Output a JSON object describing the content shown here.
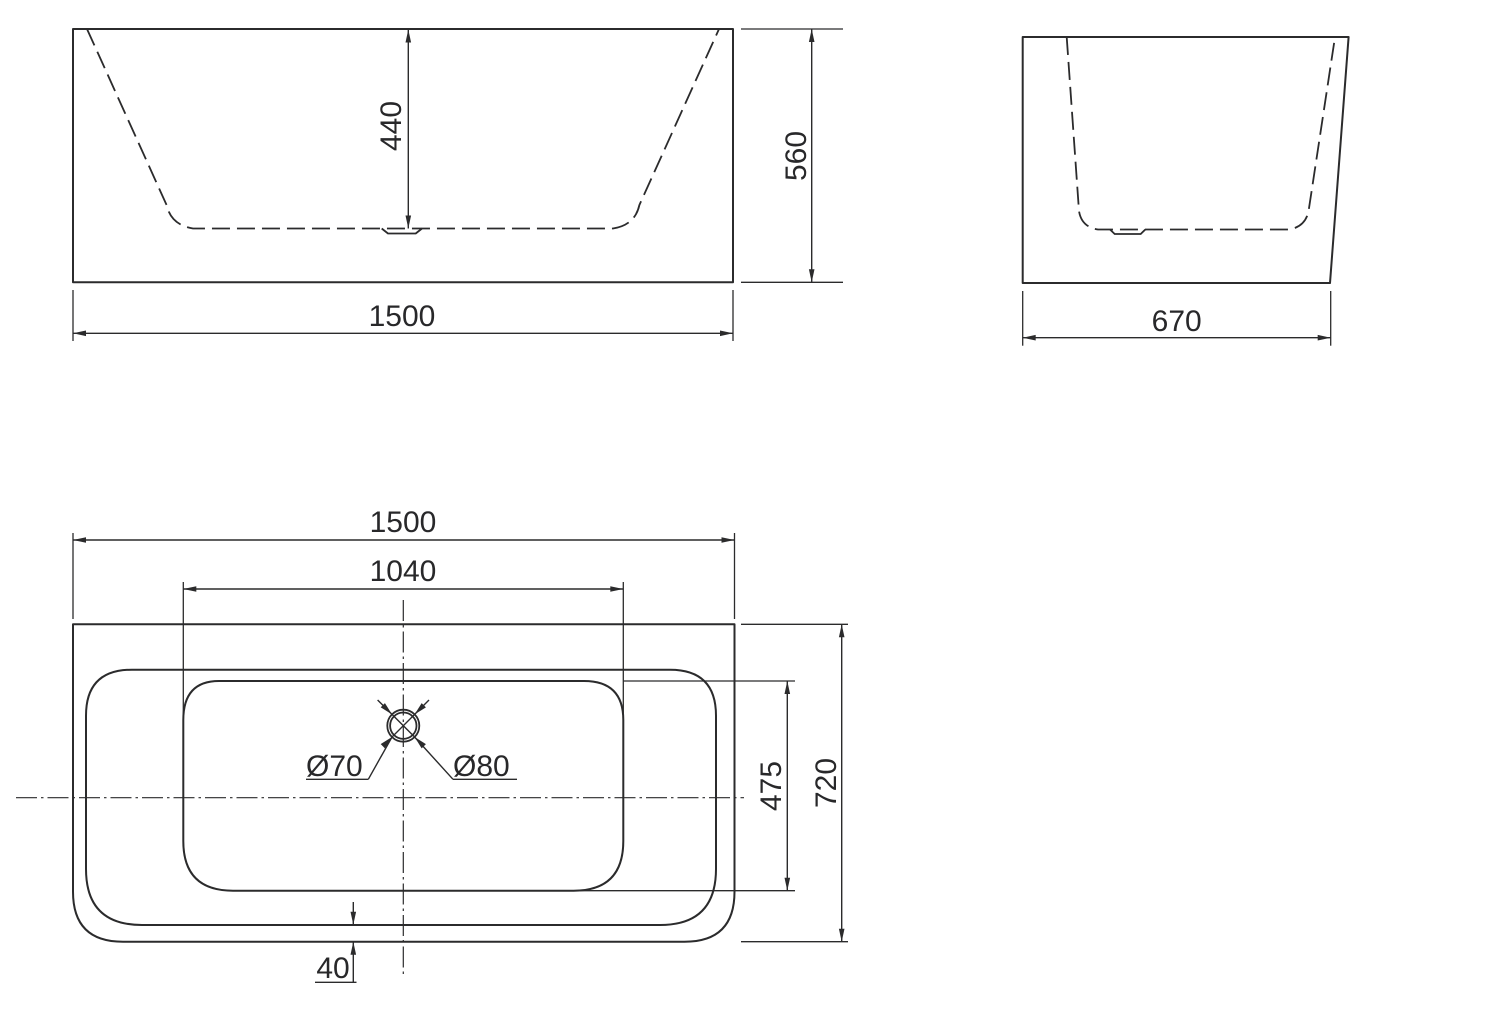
{
  "colors": {
    "background": "#ffffff",
    "line": "#2b2b2c",
    "text": "#28282a"
  },
  "front_view": {
    "inner_depth": "440",
    "overall_height": "560",
    "overall_width": "1500"
  },
  "side_view": {
    "overall_width": "670"
  },
  "plan_view": {
    "overall_width": "1500",
    "opening_width": "1040",
    "drain_inner_diameter": "Ø70",
    "drain_outer_diameter": "Ø80",
    "opening_length": "475",
    "overall_length": "720",
    "rim_edge_gap": "40"
  }
}
